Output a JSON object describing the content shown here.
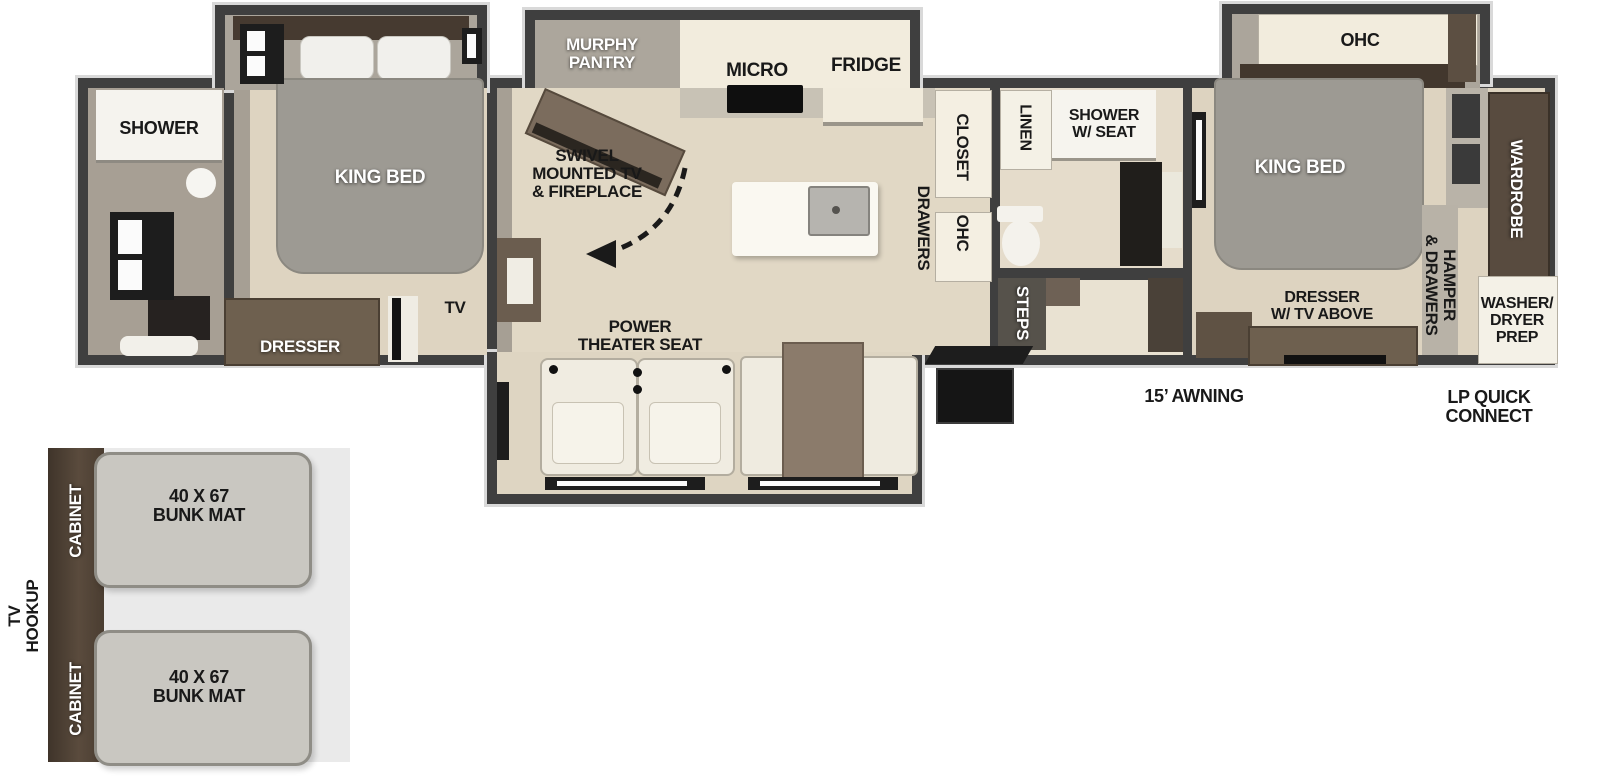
{
  "palette": {
    "wall": "#3f3f3f",
    "wall_outline": "#d9d9d9",
    "interior_wall": "#a79f94",
    "floor_tan": "#ded4c1",
    "floor_light": "#e9e2d2",
    "counter_cream": "#f2ecdd",
    "fixture_white": "#f5f3ec",
    "furniture_brown": "#6e604f",
    "wood_dark": "#473b30",
    "bed_gray": "#9d9a93",
    "mat_gray": "#c9c7c1",
    "bunk_bg": "#eaeaea",
    "entry_black": "#151515",
    "label_black": "#191919",
    "label_white": "#ffffff"
  },
  "front_bath": {
    "shower": "SHOWER"
  },
  "front_bedroom": {
    "king_bed": "KING BED",
    "dresser": "DRESSER",
    "tv": "TV"
  },
  "kitchen": {
    "murphy_pantry": [
      "MURPHY",
      "PANTRY"
    ],
    "micro": "MICRO",
    "fridge": "FRIDGE",
    "closet": "CLOSET",
    "drawers": "DRAWERS",
    "ohc": "OHC"
  },
  "living": {
    "swivel_tv": [
      "SWIVEL",
      "MOUNTED TV",
      "& FIREPLACE"
    ],
    "power_theater_seat": [
      "POWER",
      "THEATER SEAT"
    ]
  },
  "mid_bath": {
    "linen": "LINEN",
    "shower_w_seat": [
      "SHOWER",
      "W/ SEAT"
    ],
    "steps": "STEPS"
  },
  "rear_bedroom": {
    "ohc": "OHC",
    "king_bed": "KING BED",
    "wardrobe": "WARDROBE",
    "hamper_drawers": [
      "HAMPER",
      "& DRAWERS"
    ],
    "dresser_tv": [
      "DRESSER",
      "W/ TV ABOVE"
    ],
    "washer_dryer_prep": [
      "WASHER/",
      "DRYER",
      "PREP"
    ]
  },
  "exterior": {
    "awning": "15’ AWNING",
    "lp_quick_connect": [
      "LP QUICK",
      "CONNECT"
    ]
  },
  "bunk_room": {
    "tv_hookup": [
      "TV",
      "HOOKUP"
    ],
    "cabinet_top": "CABINET",
    "cabinet_bottom": "CABINET",
    "bunk_mat_top": [
      "40 X 67",
      "BUNK MAT"
    ],
    "bunk_mat_bottom": [
      "40 X 67",
      "BUNK MAT"
    ]
  }
}
